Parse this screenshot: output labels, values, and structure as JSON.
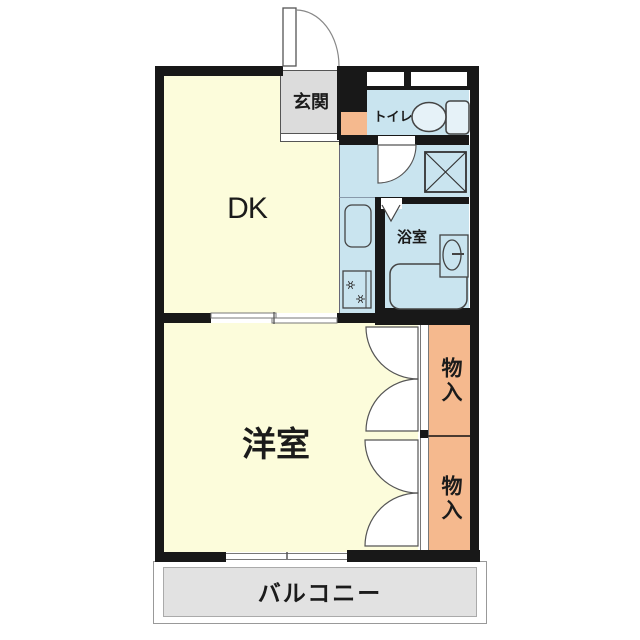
{
  "floorplan": {
    "type": "apartment-floor-plan",
    "rooms": {
      "dk": "DK",
      "western_room": "洋室",
      "entrance": "玄関",
      "toilet": "トイレ",
      "bathroom": "浴室",
      "storage_upper": "物入",
      "storage_lower": "物入",
      "balcony": "バルコニー"
    },
    "colors": {
      "wall": "#181818",
      "room_yellow": "#FCFCDB",
      "wet_area_blue": "#C9E4EF",
      "storage_orange": "#F5B98E",
      "entrance_gray": "#DCDCDC",
      "balcony_gray": "#E2E2E2"
    }
  }
}
